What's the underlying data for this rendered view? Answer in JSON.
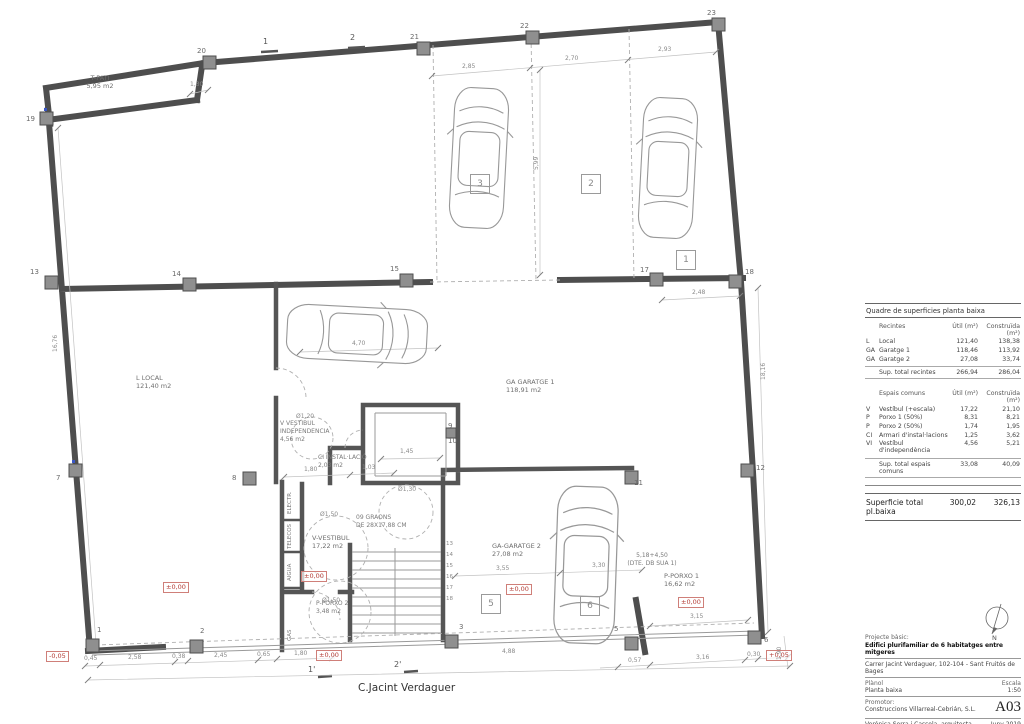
{
  "plan": {
    "street": "C.Jacint Verdaguer",
    "rooms": {
      "pati": {
        "l1": "T-PATI",
        "l2": "5,95 m2"
      },
      "local": {
        "l1": "L  LOCAL",
        "l2": "121,40 m2"
      },
      "garatge1": {
        "l1": "GA  GARATGE 1",
        "l2": "118,91 m2"
      },
      "vindep": {
        "l1": "V  VESTIBUL",
        "l2": "INDEPENDENCIA",
        "l3": "4,56 m2"
      },
      "instal": {
        "l1": "CI  INSTAL·LACIÓ",
        "l2": "2,03 m2"
      },
      "vestibul": {
        "l1": "V-VESTIBUL",
        "l2": "17,22 m2"
      },
      "graons": {
        "l1": "09 GRAONS",
        "l2": "DE 28X17,88 CM"
      },
      "porxo2": {
        "l1": "P-PORXO 2",
        "l2": "3,48 m2"
      },
      "garatge2": {
        "l1": "GA-GARATGE 2",
        "l2": "27,08 m2"
      },
      "porxo1": {
        "l1": "P-PORXO 1",
        "l2": "16,62 m2"
      },
      "sua_note": {
        "l1": "5,18+4,50",
        "l2": "(DTE. DB SUA 1)"
      }
    },
    "closets": [
      "ELECTR.",
      "TELECOS",
      "AIGUA",
      "GAS"
    ],
    "circles": {
      "c120": "Ø1,20",
      "c150a": "Ø1,50",
      "c150b": "Ø1,50",
      "c130": "Ø1,30"
    },
    "parking": {
      "s1": "1",
      "s2": "2",
      "s3": "3",
      "s5": "5",
      "s6": "6"
    },
    "grid": {
      "g1": "1",
      "g2": "2",
      "g3": "3",
      "g5": "5",
      "g6": "6",
      "g7": "7",
      "g8": "8",
      "g9": "9",
      "g10": "10",
      "g11": "11",
      "g12": "12",
      "g13": "13",
      "g14": "14",
      "g15": "15",
      "g17": "17",
      "g18": "18",
      "g19": "19",
      "g20": "20",
      "g21": "21",
      "g22": "22",
      "g23": "23"
    },
    "sections": {
      "s1": "1",
      "s2": "2",
      "s1b": "1'",
      "s2b": "2'"
    },
    "levels": {
      "minus": "-0,05",
      "zero": "±0,00",
      "plus": "+0,05"
    },
    "stairs": {
      "numbers": [
        "13",
        "14",
        "15",
        "16",
        "17",
        "18"
      ]
    },
    "dims": {
      "top1": "2,85",
      "top2": "2,70",
      "top3": "2,93",
      "v1": "5,99",
      "pat": "1,30",
      "mid": "2,48",
      "left": "16,76",
      "right": "18,16",
      "car": "4,70",
      "elev": "1,45",
      "vest1": "1,80",
      "vest2": "1,03",
      "g2a": "3,55",
      "g2b": "3,30",
      "p1": "3,15",
      "bl1": "0,45",
      "bl2": "2,58",
      "bl3": "0,38",
      "bl4": "2,45",
      "bl5": "0,65",
      "bl6": "1,80",
      "br0": "4,88",
      "br1": "0,57",
      "br2": "3,16",
      "br3": "0,30",
      "br4": "1,90"
    }
  },
  "table": {
    "title": "Quadre de superficies planta baixa",
    "col_util": "Útil (m²)",
    "col_built": "Construïda (m²)",
    "recintes": {
      "header": "Recintes",
      "rows": [
        {
          "code": "L",
          "name": "Local",
          "util": "121,40",
          "built": "138,38"
        },
        {
          "code": "GA",
          "name": "Garatge 1",
          "util": "118,46",
          "built": "113,92"
        },
        {
          "code": "GA",
          "name": "Garatge 2",
          "util": "27,08",
          "built": "33,74"
        }
      ],
      "total_label": "Sup. total recintes",
      "total_util": "266,94",
      "total_built": "286,04"
    },
    "espais": {
      "header": "Espais comuns",
      "rows": [
        {
          "code": "V",
          "name": "Vestíbul (+escala)",
          "util": "17,22",
          "built": "21,10"
        },
        {
          "code": "P",
          "name": "Porxo 1 (50%)",
          "util": "8,31",
          "built": "8,21"
        },
        {
          "code": "P",
          "name": "Porxo 2 (50%)",
          "util": "1,74",
          "built": "1,95"
        },
        {
          "code": "CI",
          "name": "Armari d'instal·lacions",
          "util": "1,25",
          "built": "3,62"
        },
        {
          "code": "VI",
          "name": "Vestíbul d'independència",
          "util": "4,56",
          "built": "5,21"
        }
      ],
      "total_label": "Sup. total espais comuns",
      "total_util": "33,08",
      "total_built": "40,09"
    },
    "grand": {
      "label": "Superficie total pl.baixa",
      "util": "300,02",
      "built": "326,13"
    }
  },
  "titleblock": {
    "project_type": "Projecte bàsic:",
    "project_title": "Edifici plurifamiliar de 6 habitatges entre mitgeres",
    "address": "Carrer Jacint Verdaguer, 102-104 - Sant Fruitós de Bages",
    "plan_label": "Plànol",
    "plan_name": "Planta baixa",
    "scale_label": "Escala",
    "scale_value": "1:50",
    "promoter_label": "Promotor:",
    "promoter": "Construccions Villarreal-Cebrián, S.L.",
    "sheet": "A03",
    "architect": "Verónica Serra i Cassola, arquitecta",
    "date": "Juny 2019",
    "north": "N"
  }
}
